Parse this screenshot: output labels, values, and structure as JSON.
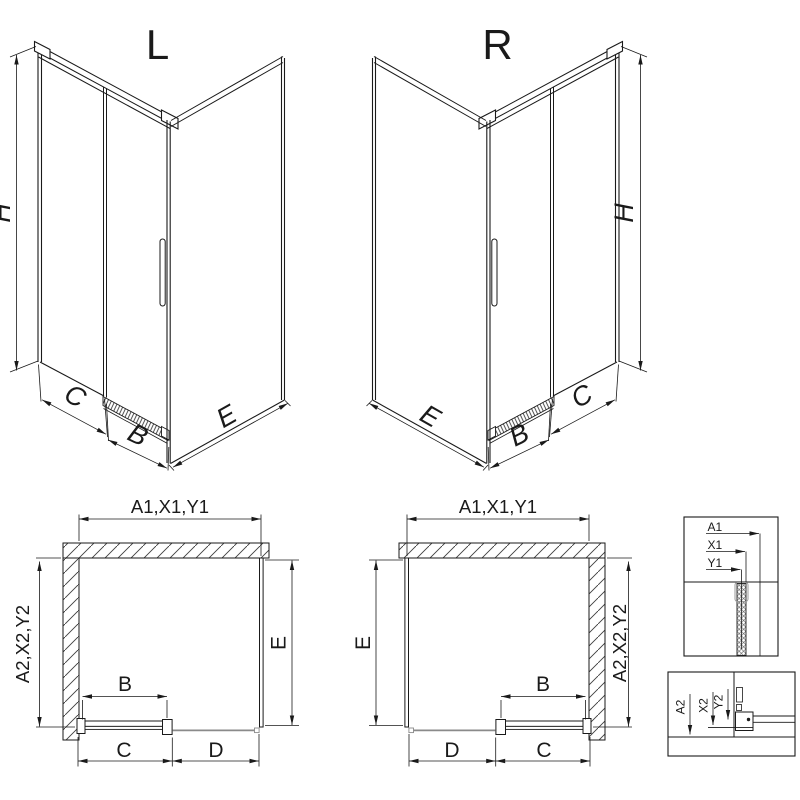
{
  "page": {
    "kind": "technical line drawing, shower enclosure L/R variants",
    "colors": {
      "line": "#1a1a1a",
      "muted": "#8a8a8a",
      "background": "#ffffff"
    }
  },
  "views": {
    "iso_left": {
      "title": "L",
      "dim_height": "H",
      "dim_c": "C",
      "dim_b": "B",
      "dim_e": "E"
    },
    "iso_right": {
      "title": "R",
      "dim_height": "H",
      "dim_c": "C",
      "dim_b": "B",
      "dim_e": "E"
    },
    "plan_left": {
      "dim_top": "A1,X1,Y1",
      "dim_wall_side": "A2,X2,Y2",
      "dim_e": "E",
      "dim_b": "B",
      "dim_c": "C",
      "dim_d": "D"
    },
    "plan_right": {
      "dim_top": "A1,X1,Y1",
      "dim_wall_side": "A2,X2,Y2",
      "dim_e": "E",
      "dim_b": "B",
      "dim_c": "C",
      "dim_d": "D"
    },
    "detail_top": {
      "label_a1": "A1",
      "label_x1": "X1",
      "label_y1": "Y1"
    },
    "detail_bottom": {
      "label_a2": "A2",
      "label_x2": "X2",
      "label_y2": "Y2"
    }
  }
}
